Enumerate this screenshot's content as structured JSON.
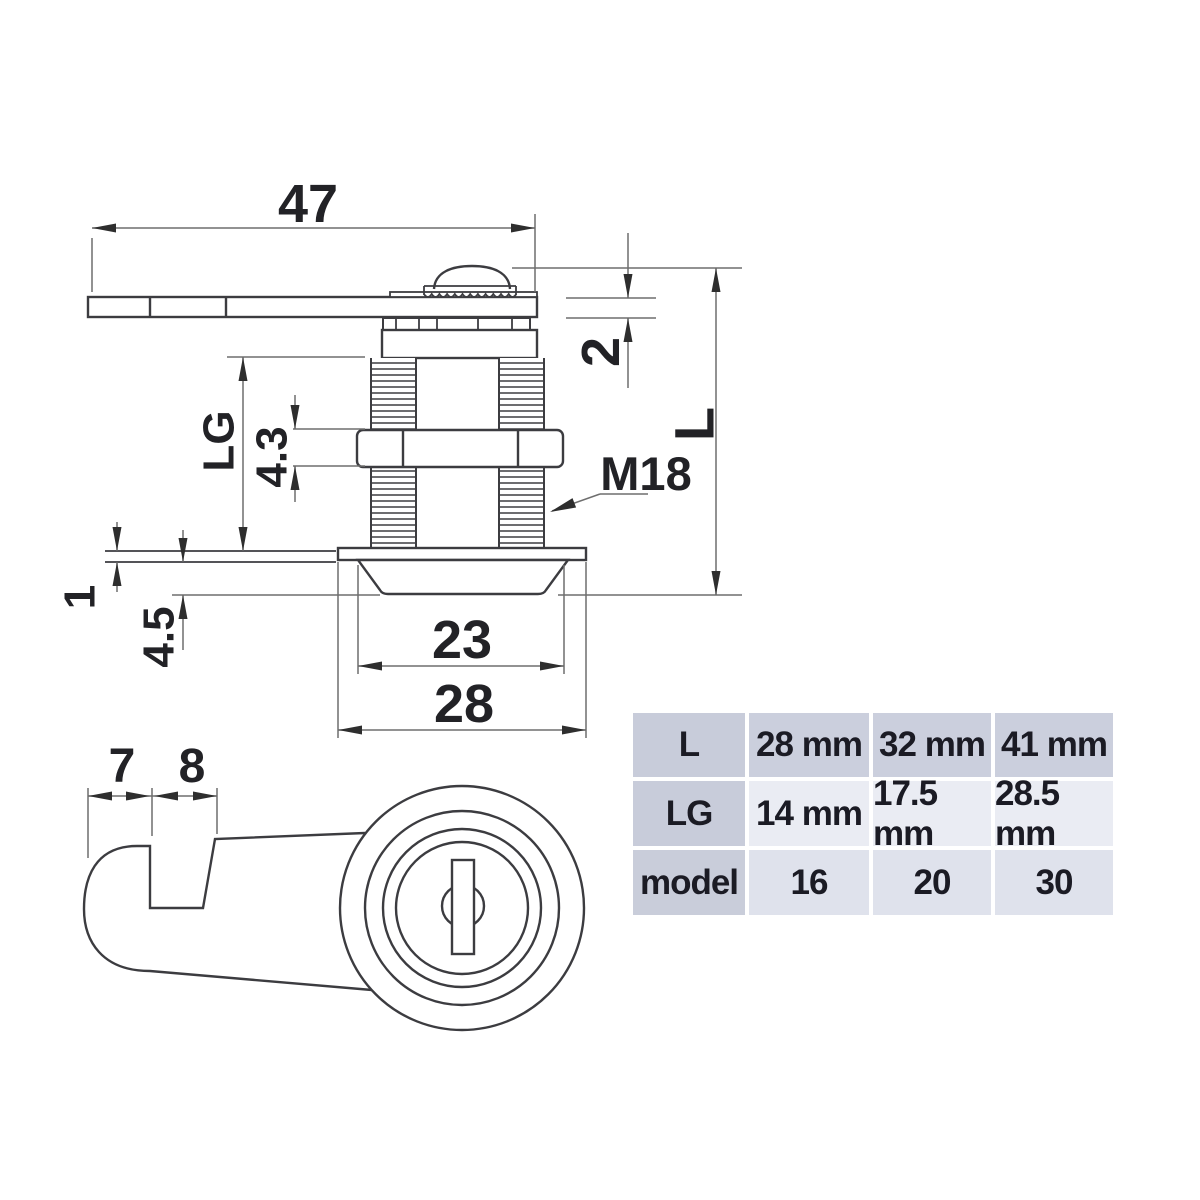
{
  "side_view": {
    "dims": {
      "cam_length": "47",
      "cam_thickness": "2",
      "body_length": "L",
      "thread_length": "LG",
      "nut_height": "4.3",
      "door_thickness": "1",
      "flange_height": "4.5",
      "flange_diameter": "23",
      "washer_diameter": "28",
      "thread_spec": "M18"
    }
  },
  "front_view": {
    "dims": {
      "hook_tip_width": "7",
      "hook_notch_width": "8"
    }
  },
  "spec_table": {
    "rows": [
      {
        "label": "L",
        "values": [
          "28 mm",
          "32 mm",
          "41 mm"
        ]
      },
      {
        "label": "LG",
        "values": [
          "14 mm",
          "17.5 mm",
          "28.5 mm"
        ]
      },
      {
        "label": "model",
        "values": [
          "16",
          "20",
          "30"
        ]
      }
    ]
  },
  "colors": {
    "part_line": "#3c3c40",
    "dim_line": "#6e6e6e",
    "arrow": "#2e2e2e",
    "table_header_bg": "#c8ccda",
    "table_row1_bg": "#cbcfdd",
    "table_row2_bg": "#eaecf3",
    "table_row3_bg": "#dfe2ec",
    "table_text": "#1b1b24"
  }
}
